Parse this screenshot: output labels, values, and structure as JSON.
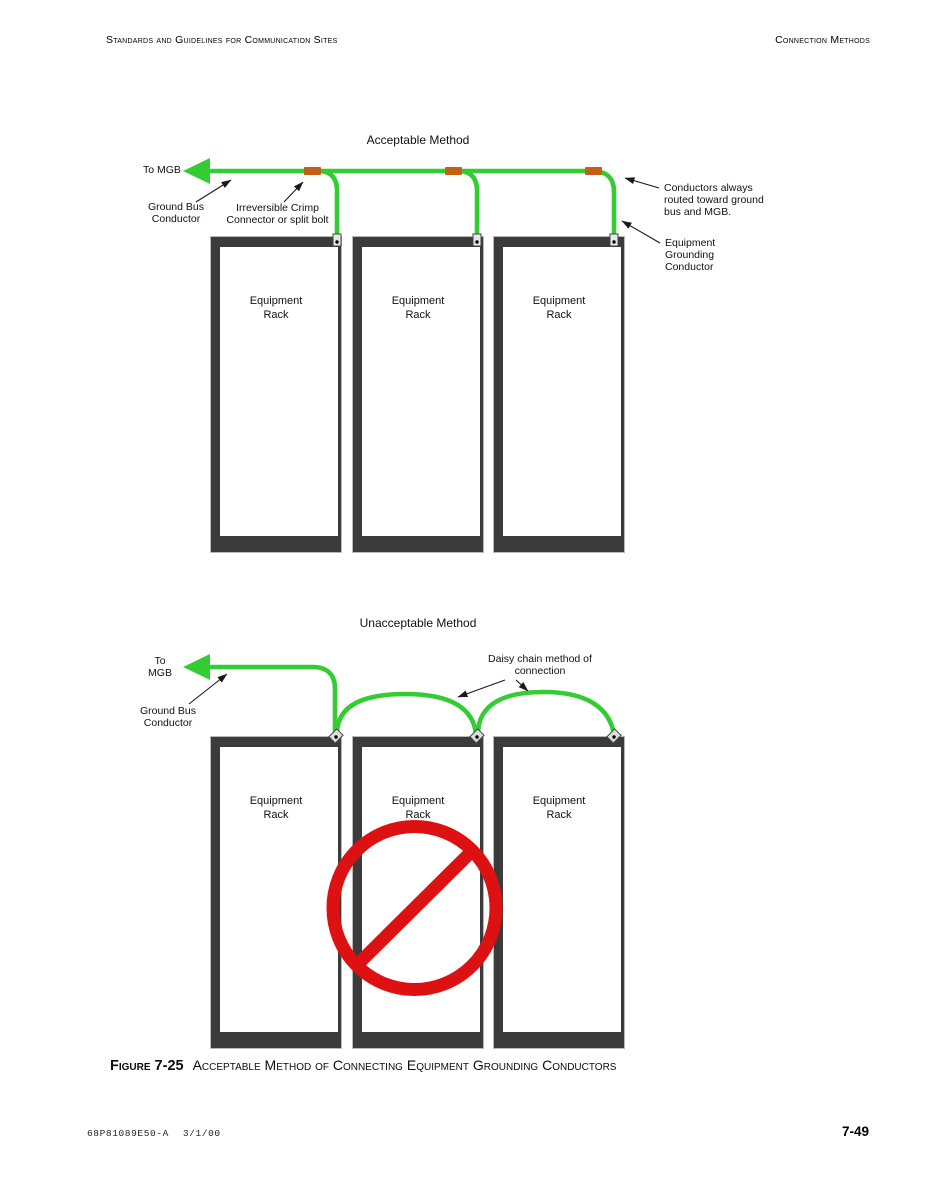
{
  "page": {
    "header_left": "Standards  and Guidelines for Communication Sites",
    "header_right": "Connection Methods",
    "caption_label": "Figure 7-25",
    "caption_text": "Acceptable Method of Connecting Equipment Grounding Conductors",
    "footer_doc": "68P81089E50-A",
    "footer_date": "3/1/00",
    "footer_page": "7-49"
  },
  "colors": {
    "wire_green": "#33cc33",
    "crimp_orange": "#c2601a",
    "prohibited_red": "#dd1111",
    "rack_gray": "#3b3b3b",
    "annotation_black": "#1a1a1a"
  },
  "acceptable": {
    "title": "Acceptable Method",
    "to_mgb": "To MGB",
    "ground_bus": "Ground Bus\nConductor",
    "crimp": "Irreversible Crimp\nConnector or split bolt",
    "routed": "Conductors always\nrouted toward ground\nbus and MGB.",
    "equip_ground": "Equipment\nGrounding\nConductor",
    "racks": [
      "Equipment\nRack",
      "Equipment\nRack",
      "Equipment\nRack"
    ]
  },
  "unacceptable": {
    "title": "Unacceptable Method",
    "to_mgb": "To\nMGB",
    "ground_bus": "Ground Bus\nConductor",
    "daisy": "Daisy chain method of\nconnection",
    "racks": [
      "Equipment\nRack",
      "Equipment\nRack",
      "Equipment\nRack"
    ]
  }
}
